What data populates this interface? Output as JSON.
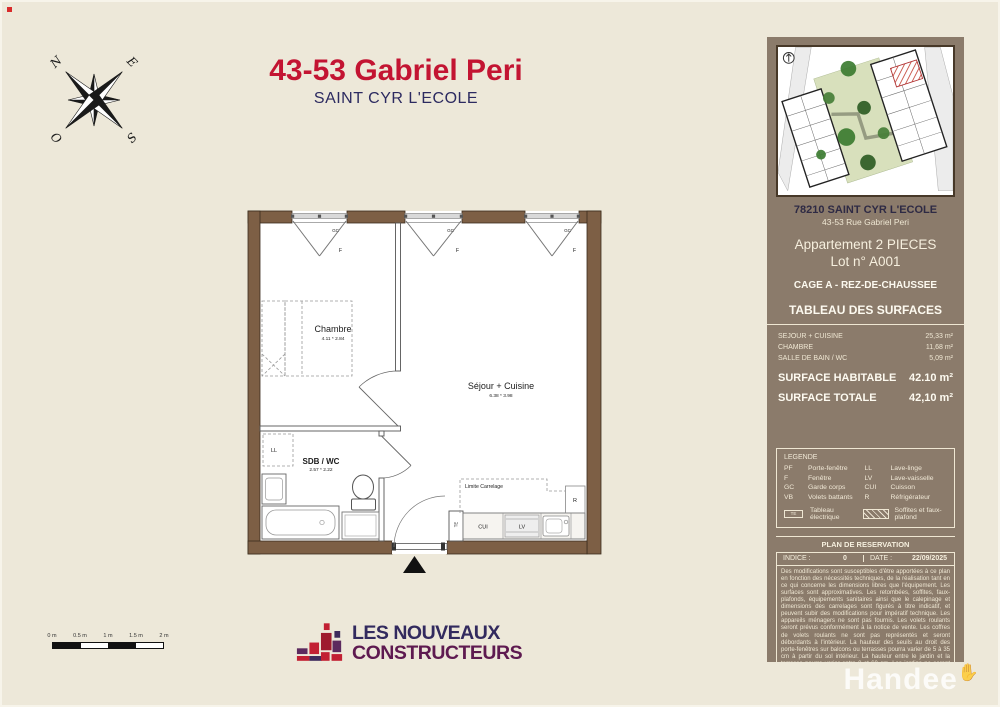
{
  "header": {
    "title": "43-53 Gabriel Peri",
    "subtitle": "SAINT CYR L'ECOLE"
  },
  "compass": {
    "n": "N",
    "e": "E",
    "o": "O",
    "s": "S"
  },
  "plan": {
    "rooms": [
      {
        "name": "Chambre",
        "dims": "4.11 * 2.84"
      },
      {
        "name": "Séjour + Cuisine",
        "dims": "6.38 * 3.98"
      },
      {
        "name": "SDB / WC",
        "dims": "2.57 * 2.22"
      }
    ],
    "labels": {
      "gc": "GC",
      "f": "F",
      "ll": "LL",
      "cui": "CUI",
      "lv": "LV",
      "r": "R",
      "te": "TE",
      "limite": "Limite Carrelage"
    }
  },
  "scalebar": {
    "ticks": [
      "0 m",
      "0.5 m",
      "1 m",
      "1.5 m",
      "2 m"
    ]
  },
  "logo": {
    "line1": "LES NOUVEAUX",
    "line2": "CONSTRUCTEURS"
  },
  "sidebar": {
    "address_title": "78210 SAINT CYR L'ECOLE",
    "address_sub": "43-53 Rue Gabriel Peri",
    "apartment": "Appartement 2 PIECES",
    "lot": "Lot n° A001",
    "cage": "CAGE A - REZ-DE-CHAUSSEE",
    "surfaces_title": "TABLEAU DES SURFACES",
    "surfaces": [
      {
        "label": "SEJOUR  + CUISINE",
        "value": "25,33 m²"
      },
      {
        "label": "CHAMBRE",
        "value": "11,68 m²"
      },
      {
        "label": "SALLE DE BAIN / WC",
        "value": "5,09 m²"
      }
    ],
    "habitable": {
      "label": "SURFACE HABITABLE",
      "value": "42.10 m²"
    },
    "totale": {
      "label": "SURFACE TOTALE",
      "value": "42,10 m²"
    },
    "legend": {
      "title": "LEGENDE",
      "left": [
        {
          "abbr": "PF",
          "label": "Porte-fenêtre"
        },
        {
          "abbr": "F",
          "label": "Fenêtre"
        },
        {
          "abbr": "GC",
          "label": "Garde corps"
        },
        {
          "abbr": "VB",
          "label": "Volets battants"
        }
      ],
      "right": [
        {
          "abbr": "LL",
          "label": "Lave-linge"
        },
        {
          "abbr": "LV",
          "label": "Lave-vaisselle"
        },
        {
          "abbr": "CUI",
          "label": "Cuisson"
        },
        {
          "abbr": "R",
          "label": "Réfrigérateur"
        }
      ],
      "te": {
        "abbr": "TE",
        "label": "Tableau électrique"
      },
      "soffites": {
        "label": "Soffites et faux-plafond"
      }
    },
    "reservation": {
      "title": "PLAN DE RESERVATION",
      "indice_label": "INDICE :",
      "indice_value": "0",
      "date_label": "DATE :",
      "date_value": "22/09/2025",
      "disclaimer": "Des modifications sont susceptibles d'être apportées à ce plan en fonction des nécessités techniques, de la réalisation tant en ce qui concerne les dimensions libres que l'équipement. Les surfaces sont approximatives. Les retombées, soffites, faux-plafonds, équipements sanitaires ainsi que le calepinage et dimensions des carrelages sont figurés à titre indicatif, et peuvent subir des modifications pour impératif technique. Les appareils ménagers ne sont pas fournis. Les volets roulants seront prévus conformément à la notice de vente. Les coffres de volets roulants ne sont pas représentés et seront débordants à l'intérieur. La hauteur des seuils au droit des porte-fenêtres sur balcons ou terrasses pourra varier de 5 à 35 cm à partir du sol intérieur. La hauteur entre le jardin et la terrasse pourra varier entre 0 et 60 cm. Les jardins ne seront pas nécessairement plats et pourront comporter des talus et des pentes."
    }
  },
  "watermark": {
    "text": "Handee"
  },
  "colors": {
    "page_bg": "#EDE8D9",
    "sidebar_bg": "#8B7B6B",
    "title_red": "#C31432",
    "navy": "#2C2A60",
    "wall_brown": "#7D5F45",
    "logo_navy": "#322A5E",
    "logo_plum": "#5E1A50",
    "logo_red": "#C22033"
  }
}
